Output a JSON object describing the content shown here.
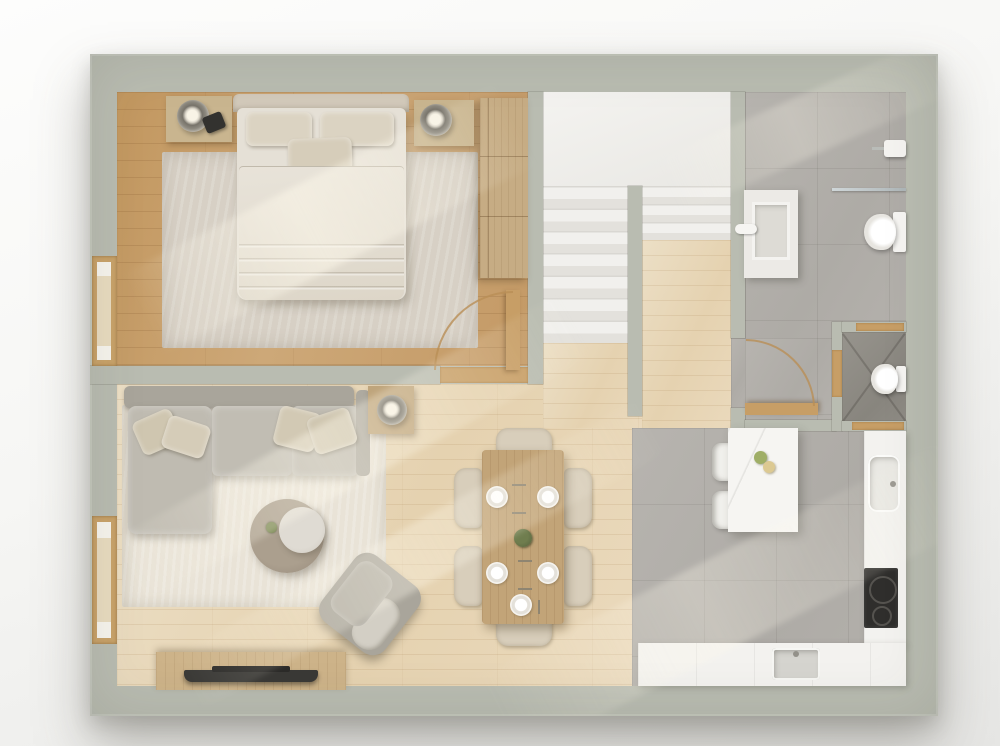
{
  "title": "Apartment floor plan — photorealistic top-down 3D render, no text labels",
  "palette": {
    "wall": "#b9bcb1",
    "wood_bedroom": "#c79e6e",
    "wood_living": "#e9d9bd",
    "tile_bathroom": "#b3b0ab",
    "tile_wc": "#908d86",
    "tile_kitchen": "#b3b0ab",
    "stairs": "#f1f0ed",
    "rug_bedroom": "#d7d0c5",
    "rug_living": "#e9e3d7",
    "sofa": "#bdb9af",
    "counter": "#f3f2ef",
    "cooktop": "#2f2e2c",
    "door_accent_wood": "#c79e66",
    "linen": "#e5e0d6"
  },
  "rooms": {
    "bedroom": {
      "name": "Bedroom",
      "furniture": [
        "double-bed",
        "pillows x3",
        "duvet",
        "nightstand-left",
        "nightstand-right",
        "table-lamp x2",
        "alarm-clock",
        "wardrobe",
        "area-rug",
        "window",
        "door-open-with-swing-arc"
      ]
    },
    "living_room": {
      "name": "Living room",
      "furniture": [
        "l-shaped-sofa",
        "throw-pillows x4",
        "side-table-with-lamp",
        "round-coffee-table-wood",
        "round-coffee-table-white",
        "small-plant",
        "swivel-armchair",
        "tv-console",
        "tv",
        "area-rug",
        "window"
      ]
    },
    "dining_area": {
      "name": "Dining area",
      "furniture": [
        "wood-dining-table",
        "dining-chairs x6",
        "place-settings x5",
        "centerpiece-plant"
      ]
    },
    "kitchen": {
      "name": "Kitchen",
      "furniture": [
        "island-with-marble-top",
        "bar-stools x2",
        "fruit x2",
        "l-shaped-counter",
        "counter-sink",
        "prep-sink",
        "cooktop-2-burners"
      ]
    },
    "bathroom": {
      "name": "Bathroom",
      "furniture": [
        "vanity-sink",
        "faucet",
        "walk-in-shower-glass",
        "shower-head",
        "wall-hung-toilet",
        "door-open-with-swing-arc"
      ]
    },
    "wc": {
      "name": "WC",
      "furniture": [
        "toilet",
        "wood-thresholds"
      ]
    },
    "staircase": {
      "name": "Staircase",
      "parts": [
        "upper-landing",
        "left-flight-7-steps",
        "right-flight-3-steps",
        "center-divider-wall"
      ]
    }
  },
  "counts": {
    "dining_chairs": 6,
    "plates": 5,
    "bar_stools": 2,
    "burners": 2,
    "windows": 2,
    "door_arcs": 2
  }
}
